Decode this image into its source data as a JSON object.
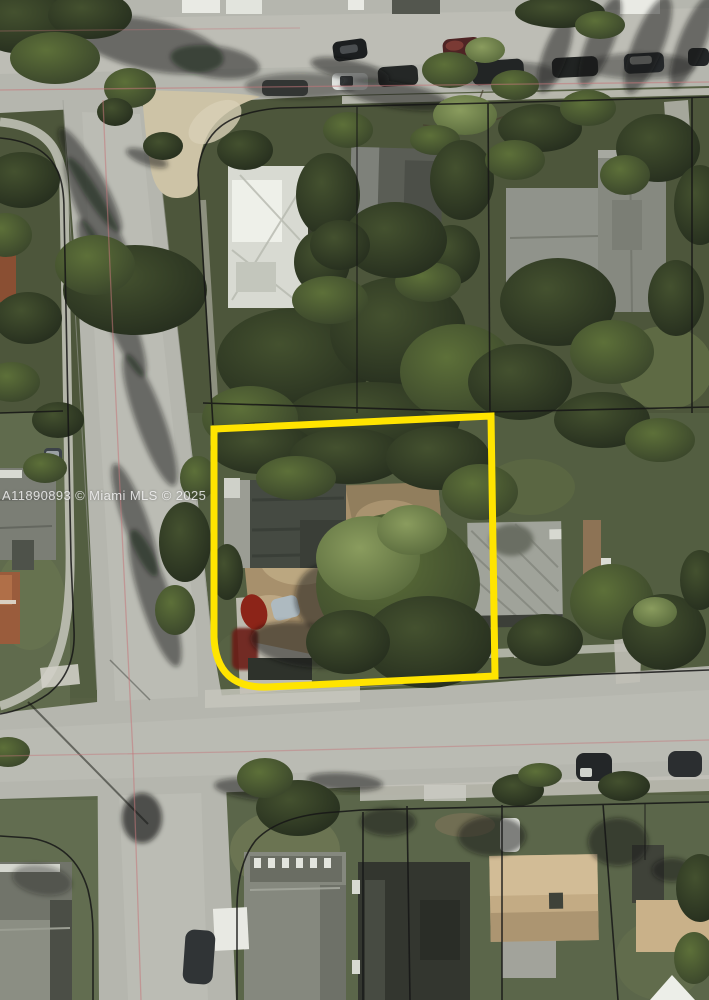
{
  "watermark": {
    "text": "A11890893 © Miami MLS © 2025"
  },
  "colors": {
    "parcel_highlight": "#ffe400",
    "parcel_line": "#161616",
    "road_centerline": "#c4767a",
    "road": "#b5b6ae",
    "dirt": "#a7906c",
    "vegetation_dark": "#2c3522"
  },
  "scene": {
    "type": "aerial-satellite-photo",
    "highlighted_parcel": "corner lot outlined in thick yellow with rounded south-west corner",
    "visible_features": [
      "horizontal street at top with parked cars",
      "vertical street on left with pink center line",
      "horizontal street at bottom of intersection",
      "black plat parcel lines over blocks",
      "residential houses and rooftops",
      "dense tree canopy",
      "dirt yard and red vehicle inside highlighted parcel"
    ]
  }
}
